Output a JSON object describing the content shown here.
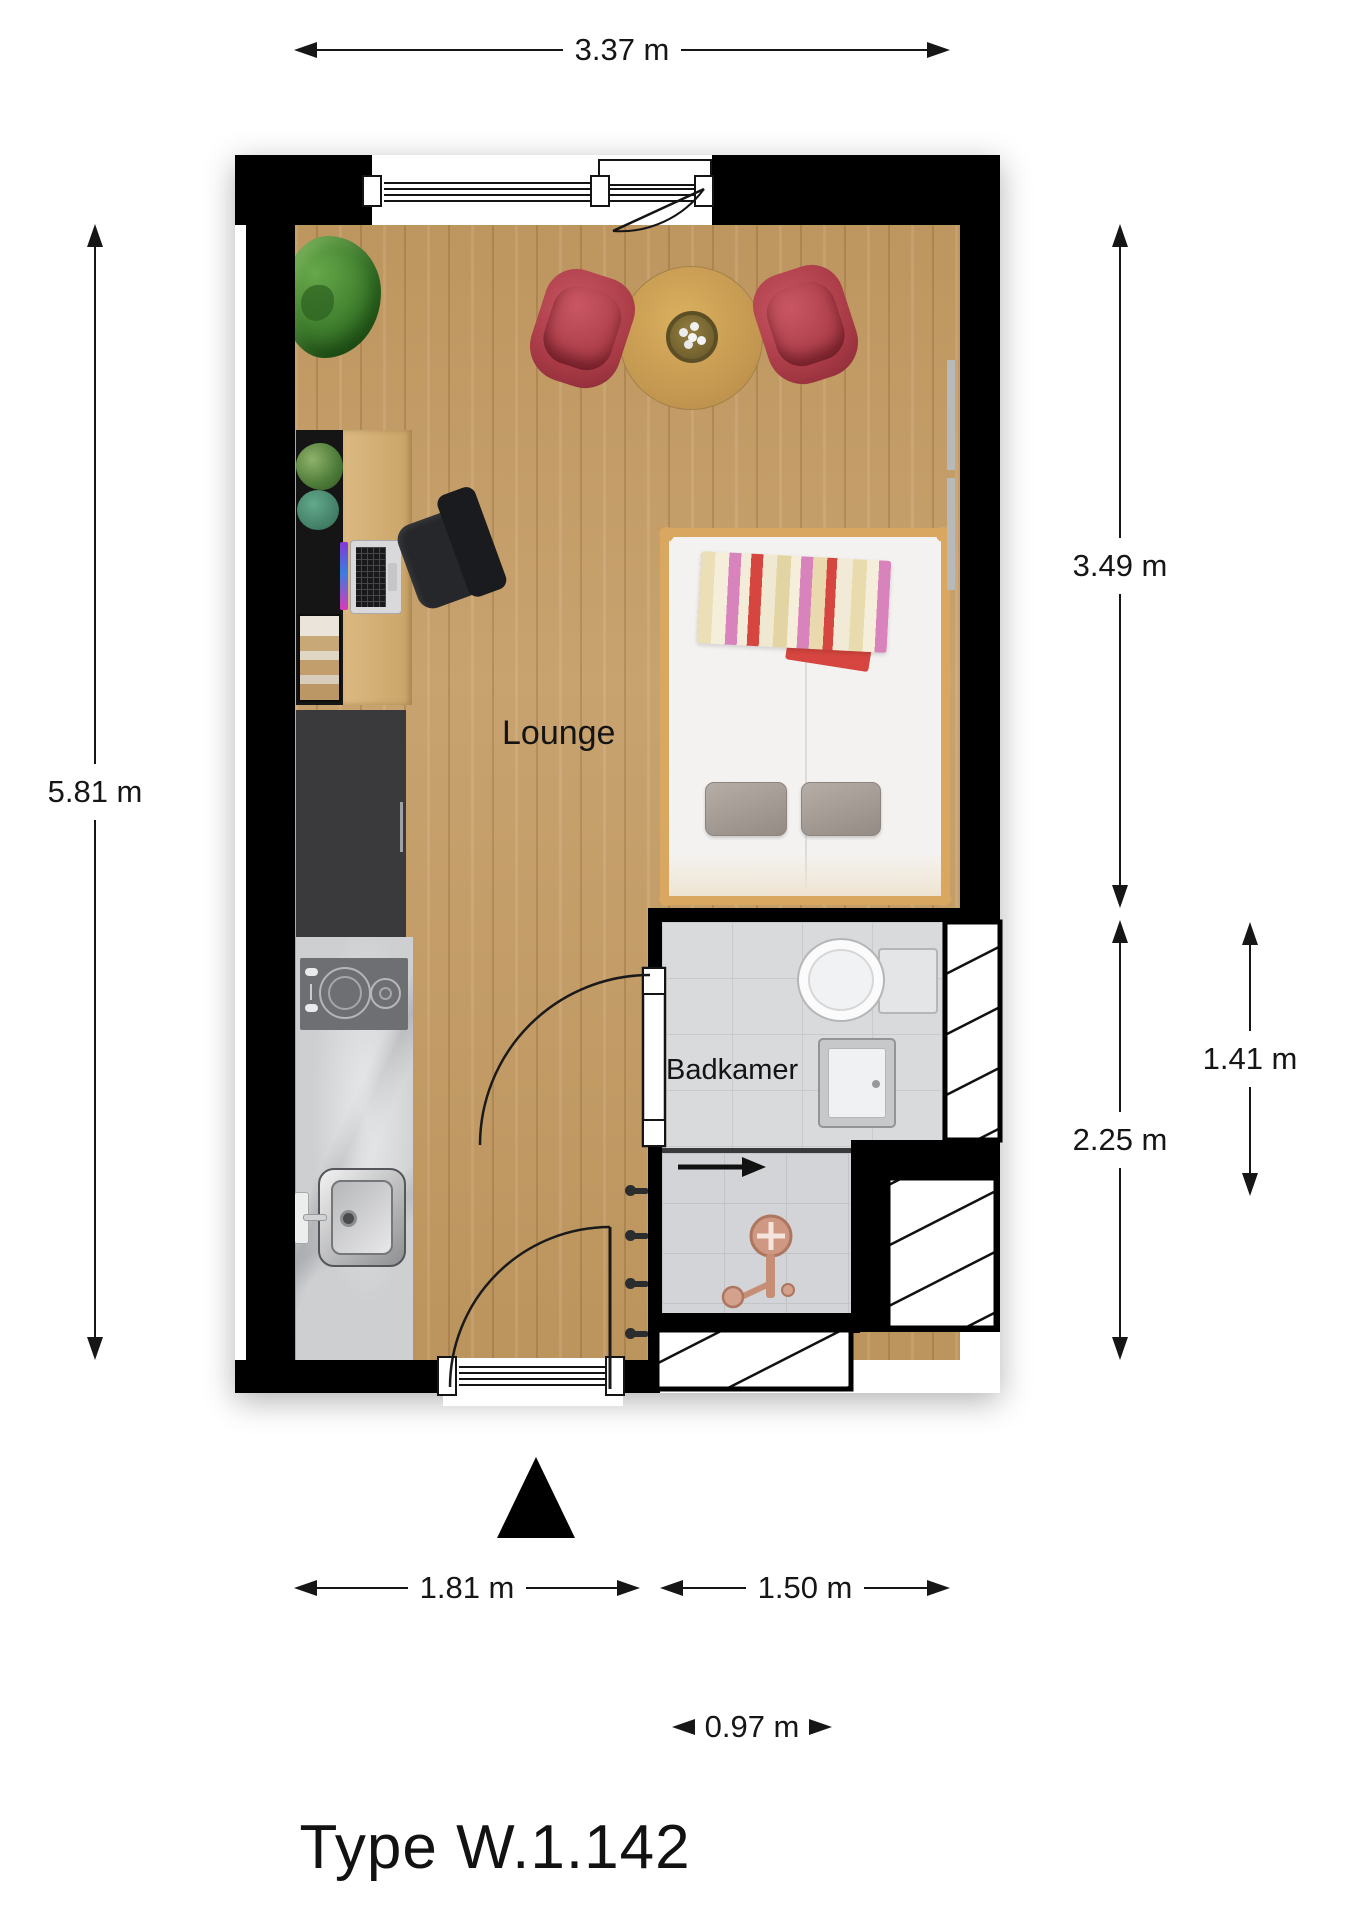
{
  "title": "Type W.1.142",
  "room_labels": {
    "lounge": "Lounge",
    "bathroom": "Badkamer"
  },
  "dimensions": {
    "top_width": "3.37 m",
    "left_height": "5.81 m",
    "right_upper_height": "3.49 m",
    "right_lower_height": "2.25 m",
    "right_inner_height": "1.41 m",
    "bottom_left_width": "1.81 m",
    "bottom_right_width": "1.50 m",
    "bottom_inner_width": "0.97 m"
  },
  "colors": {
    "wall": "#000000",
    "wood_floor": "#c59d66",
    "bathroom_tile": "#d9dadc",
    "dining_chair_red": "#a93b46",
    "bed_frame_wood": "#d9a75f",
    "shower_fixture_copper": "#c98d77",
    "plant_green": "#3d7c2c",
    "dimension_text": "#161616"
  },
  "furniture": [
    "plant",
    "dining-table",
    "dining-chairs",
    "sideboard",
    "desk",
    "laptop",
    "office-chair",
    "wardrobe",
    "kitchen-counter",
    "cooktop",
    "kitchen-sink",
    "bed",
    "pillows",
    "striped-blanket",
    "toilet",
    "bathroom-sink",
    "shower",
    "coat-hooks"
  ]
}
